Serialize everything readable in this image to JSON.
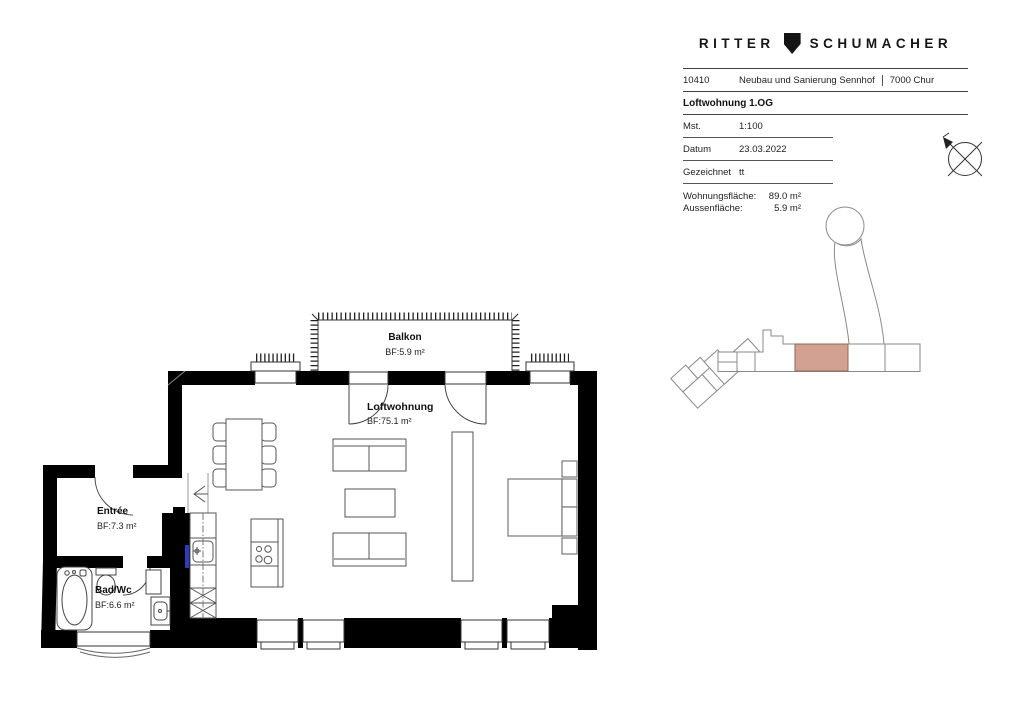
{
  "title_block": {
    "brand_left": "RITTER",
    "brand_right": "SCHUMACHER",
    "logo_icon": "shield-icon",
    "project_number": "10410",
    "project_name": "Neubau und Sanierung Sennhof",
    "project_city": "7000 Chur",
    "drawing_title": "Loftwohnung 1.OG",
    "fields": [
      {
        "label": "Mst.",
        "value": "1:100"
      },
      {
        "label": "Datum",
        "value": "23.03.2022"
      },
      {
        "label": "Gezeichnet",
        "value": "tt"
      }
    ],
    "areas": [
      {
        "label": "Wohnungsfläche:",
        "value": "89.0 m²"
      },
      {
        "label": "Aussenfläche:",
        "value": "5.9 m²"
      }
    ]
  },
  "floor_plan": {
    "rooms": [
      {
        "name": "Balkon",
        "area": "BF:5.9 m²"
      },
      {
        "name": "Loftwohnung",
        "area": "BF:75.1 m²"
      },
      {
        "name": "Entrée",
        "area": "BF:7.3 m²"
      },
      {
        "name": "Bad/Wc",
        "area": "BF:6.6 m²"
      }
    ],
    "marker_color": "#2e3bbf"
  },
  "key_plan": {
    "highlight_color": "#d2a191"
  }
}
